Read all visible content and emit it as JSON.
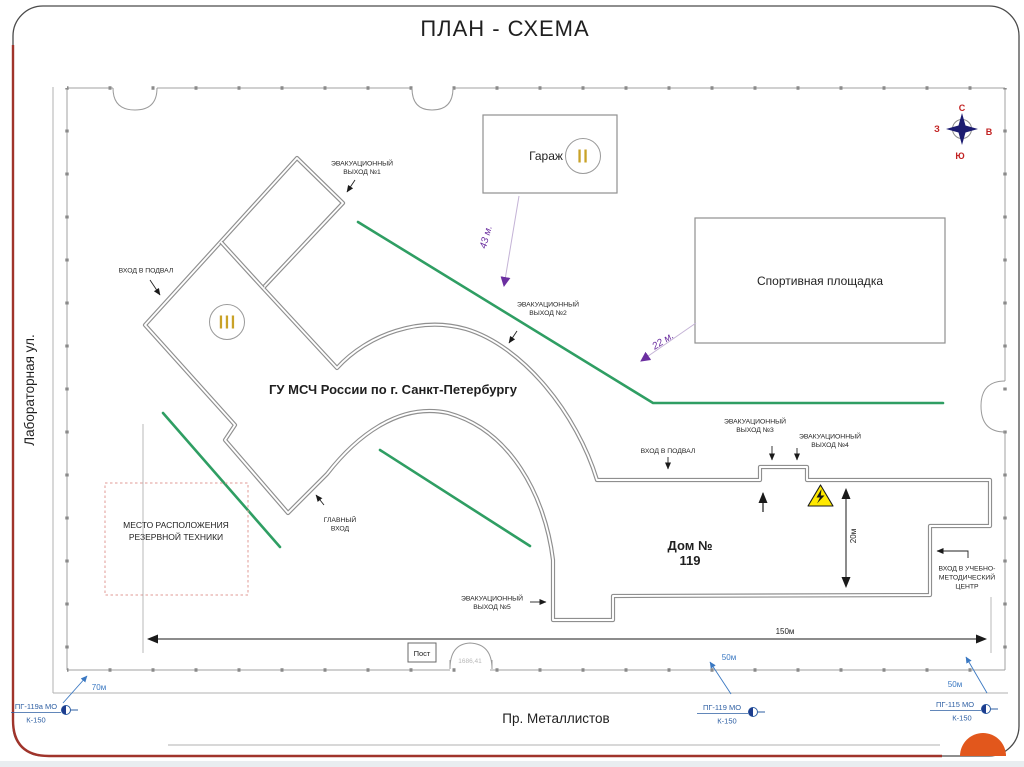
{
  "slide": {
    "title": "ПЛАН - СХЕМА"
  },
  "streets": {
    "left": "Лабораторная ул.",
    "bottom": "Пр. Металлистов"
  },
  "compass": {
    "n": "С",
    "s": "Ю",
    "w": "З",
    "e": "В"
  },
  "site": {
    "main_building": "ГУ МСЧ России по г. Санкт-Петербургу",
    "house_no_line1": "Дом №",
    "house_no_line2": "119",
    "garage": "Гараж",
    "garage_numeral": "II",
    "wing_numeral": "III",
    "sports_ground": "Спортивная площадка",
    "reserve_line1": "МЕСТО РАСПОЛОЖЕНИЯ",
    "reserve_line2": "РЕЗЕРВНОЙ ТЕХНИКИ",
    "checkpoint": "Пост",
    "gate_number": "1686,41"
  },
  "exits": {
    "e1": {
      "line1": "ЭВАКУАЦИОННЫЙ",
      "line2": "ВЫХОД №1"
    },
    "e2": {
      "line1": "ЭВАКУАЦИОННЫЙ",
      "line2": "ВЫХОД №2"
    },
    "e3": {
      "line1": "ЭВАКУАЦИОННЫЙ",
      "line2": "ВЫХОД №3"
    },
    "e4": {
      "line1": "ЭВАКУАЦИОННЫЙ",
      "line2": "ВЫХОД №4"
    },
    "e5": {
      "line1": "ЭВАКУАЦИОННЫЙ",
      "line2": "ВЫХОД №5"
    }
  },
  "entrances": {
    "basement_left": "ВХОД В ПОДВАЛ",
    "basement_bottom": "ВХОД В ПОДВАЛ",
    "main_line1": "ГЛАВНЫЙ",
    "main_line2": "ВХОД",
    "training_line1": "ВХОД В УЧЕБНО-",
    "training_line2": "МЕТОДИЧЕСКИЙ",
    "training_line3": "ЦЕНТР"
  },
  "distances": {
    "garage_route": "43 м.",
    "sports_route": "22 м.",
    "house_depth": "20м",
    "site_width": "150м",
    "hydrant1": "70м",
    "hydrant2": "50м",
    "hydrant3": "50м"
  },
  "hydrants": {
    "h1": {
      "name": "ПГ-119а МО",
      "main": "К-150"
    },
    "h2": {
      "name": "ПГ-119 МО",
      "main": "К-150"
    },
    "h3": {
      "name": "ПГ-115 МО",
      "main": "К-150"
    }
  },
  "colors": {
    "wall_gray": "#8f8f8f",
    "route_green": "#2f9e63",
    "arrow_purple": "#6b2fa0",
    "hydrant_blue": "#2e5fa3",
    "compass_red": "#c22121",
    "warning_yellow": "#ffe900",
    "frame_red": "#a0342b",
    "accent_orange": "#e2571c",
    "roman_gold": "#c9a227"
  }
}
